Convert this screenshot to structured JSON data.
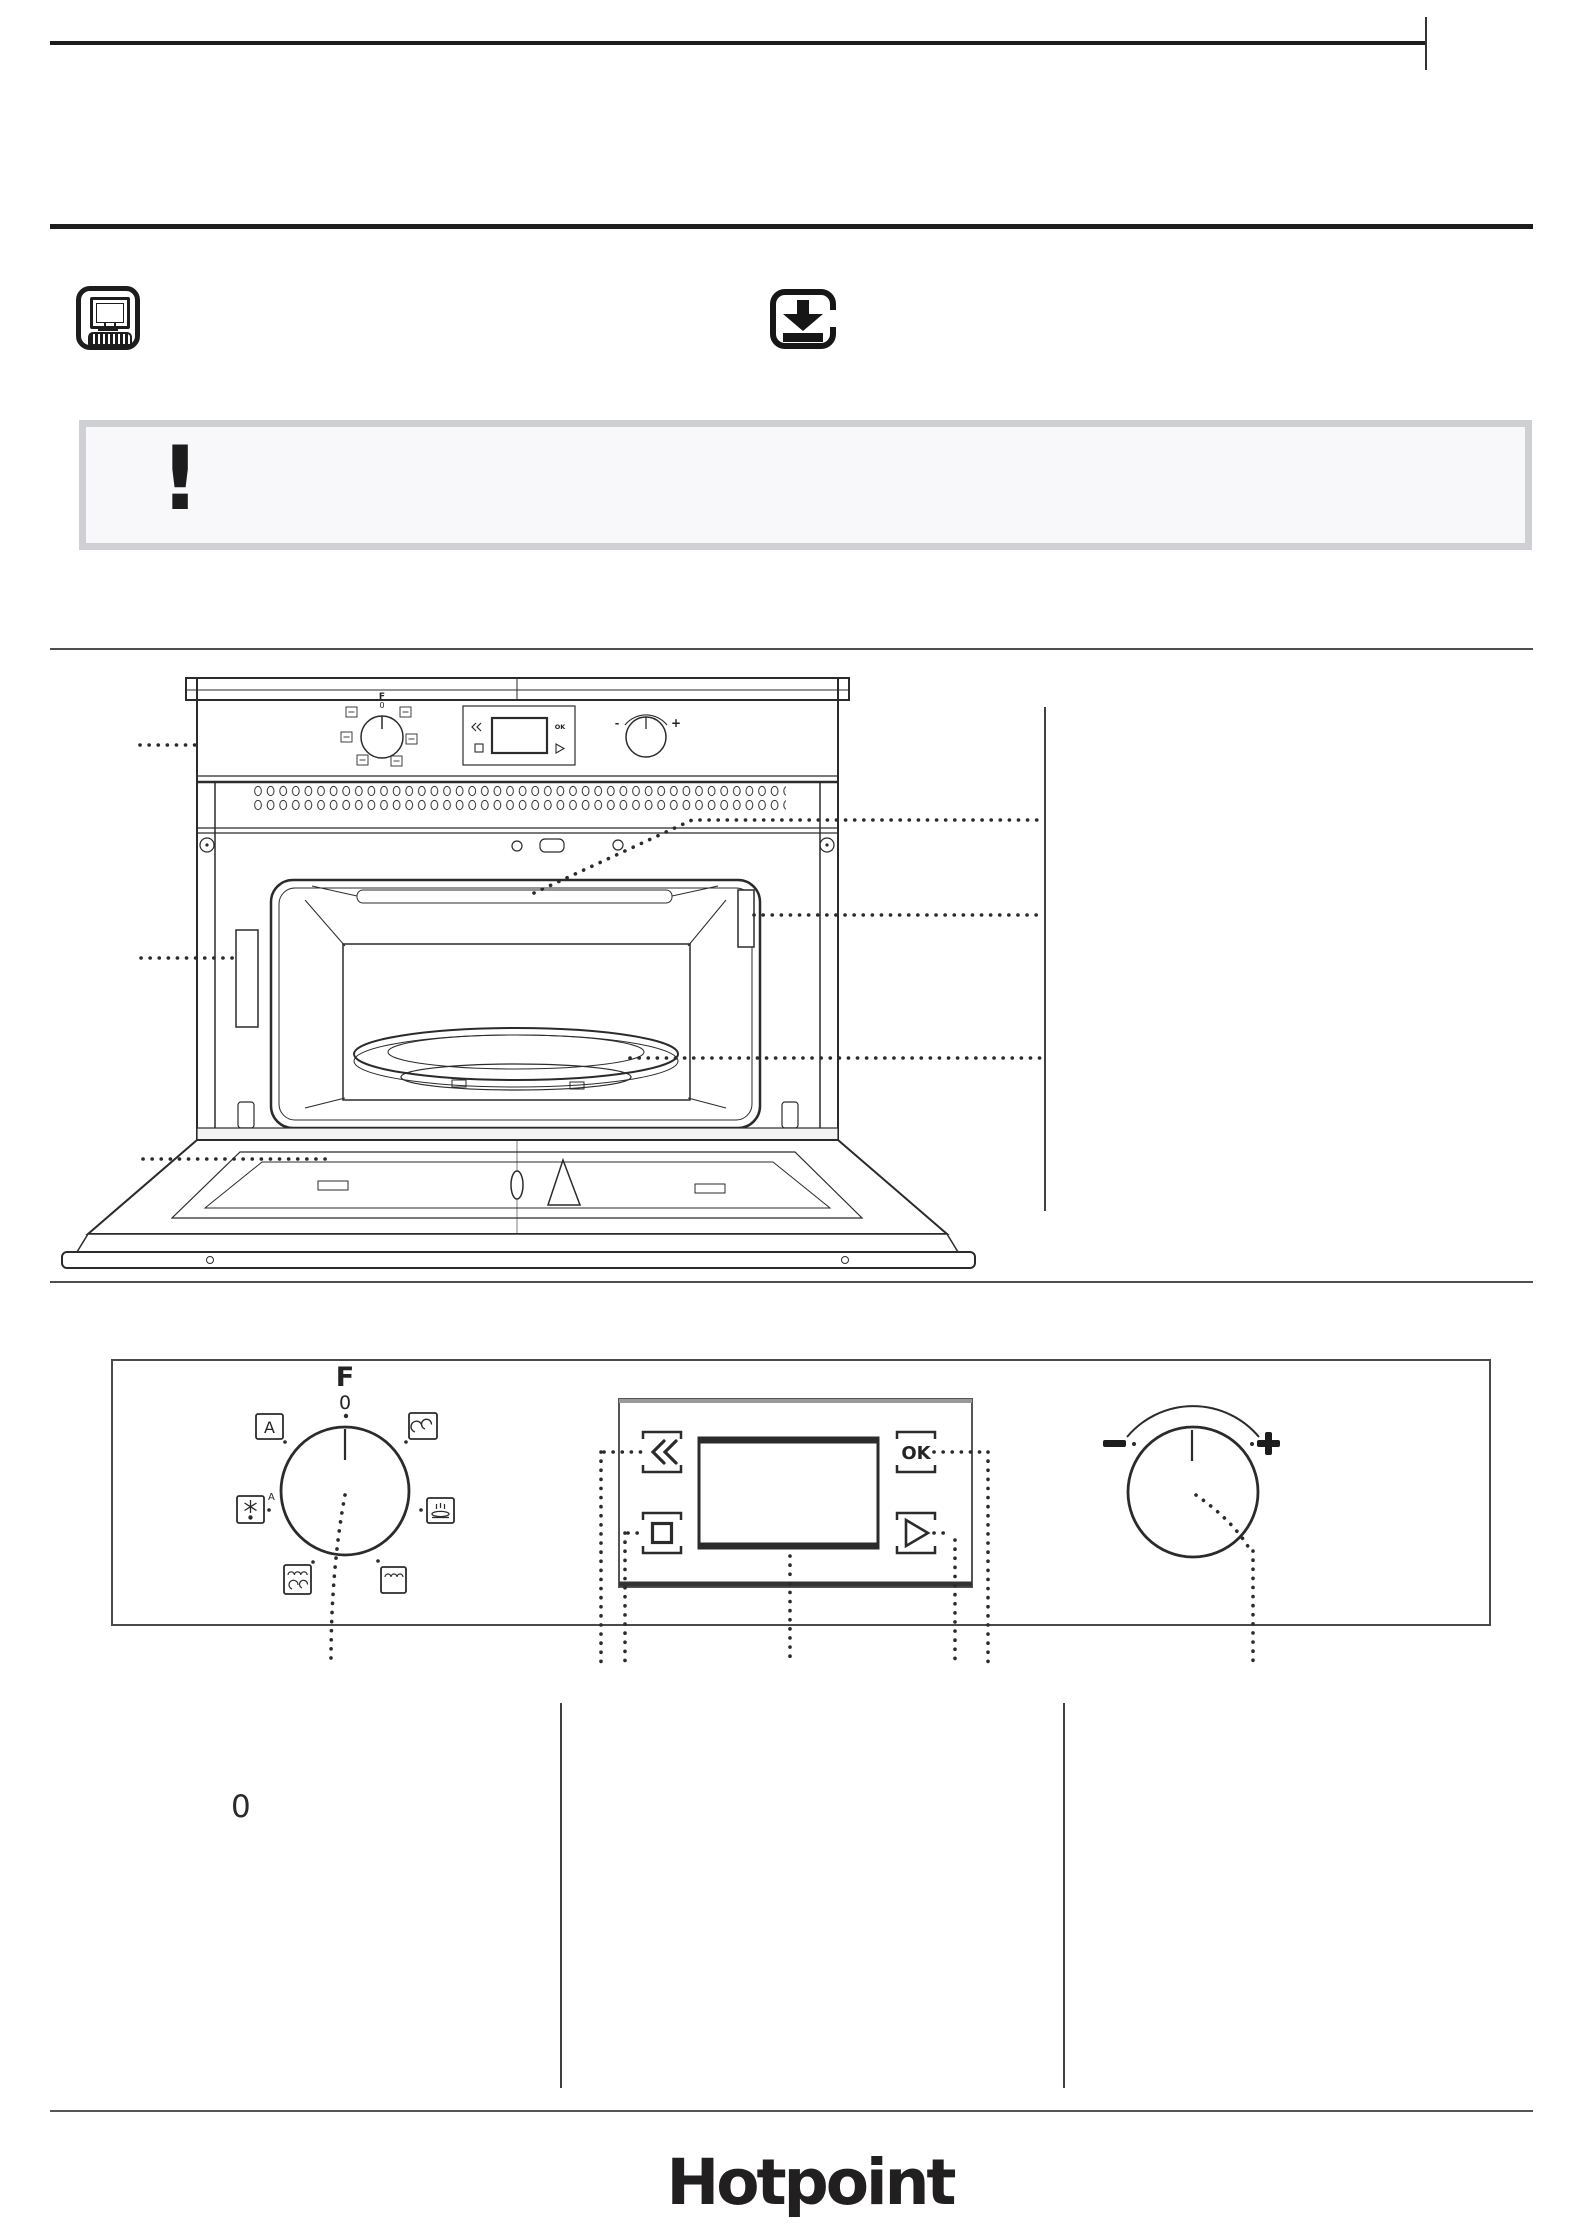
{
  "page": {
    "background": "#ffffff",
    "ink": "#242424",
    "rule_color": "#1d1d1d",
    "divider_color": "#4f4f4f",
    "table_line_color": "#3f3f3f"
  },
  "header": {
    "icons": [
      "computer-icon",
      "download-icon"
    ]
  },
  "alert": {
    "symbol": "!",
    "border_color": "#cfd0d3",
    "background_color": "#f8f7fa"
  },
  "oven_diagram": {
    "mini_panel": {
      "f_label": "F",
      "zero_label": "0",
      "minus": "-",
      "plus": "+",
      "ok": "OK"
    },
    "callouts": [
      "control-panel",
      "cavity-ceiling",
      "lamp",
      "turntable",
      "door-latch",
      "door"
    ]
  },
  "control_panel": {
    "function_knob": {
      "f_label": "F",
      "zero_label": "0",
      "auto_label": "A",
      "defrost_sup_label": "A",
      "modes": [
        "auto",
        "grill-fan",
        "defrost",
        "reheat",
        "microwave-grill",
        "grill"
      ]
    },
    "display": {
      "back": "≪",
      "ok": "OK",
      "stop": "stop-square",
      "start": "play-triangle"
    },
    "adjust_knob": {
      "minus": "-",
      "plus": "+"
    }
  },
  "settings": {
    "zero_symbol": "0"
  },
  "footer": {
    "brand": "Hotpoint",
    "brand_color": "#221f20"
  }
}
